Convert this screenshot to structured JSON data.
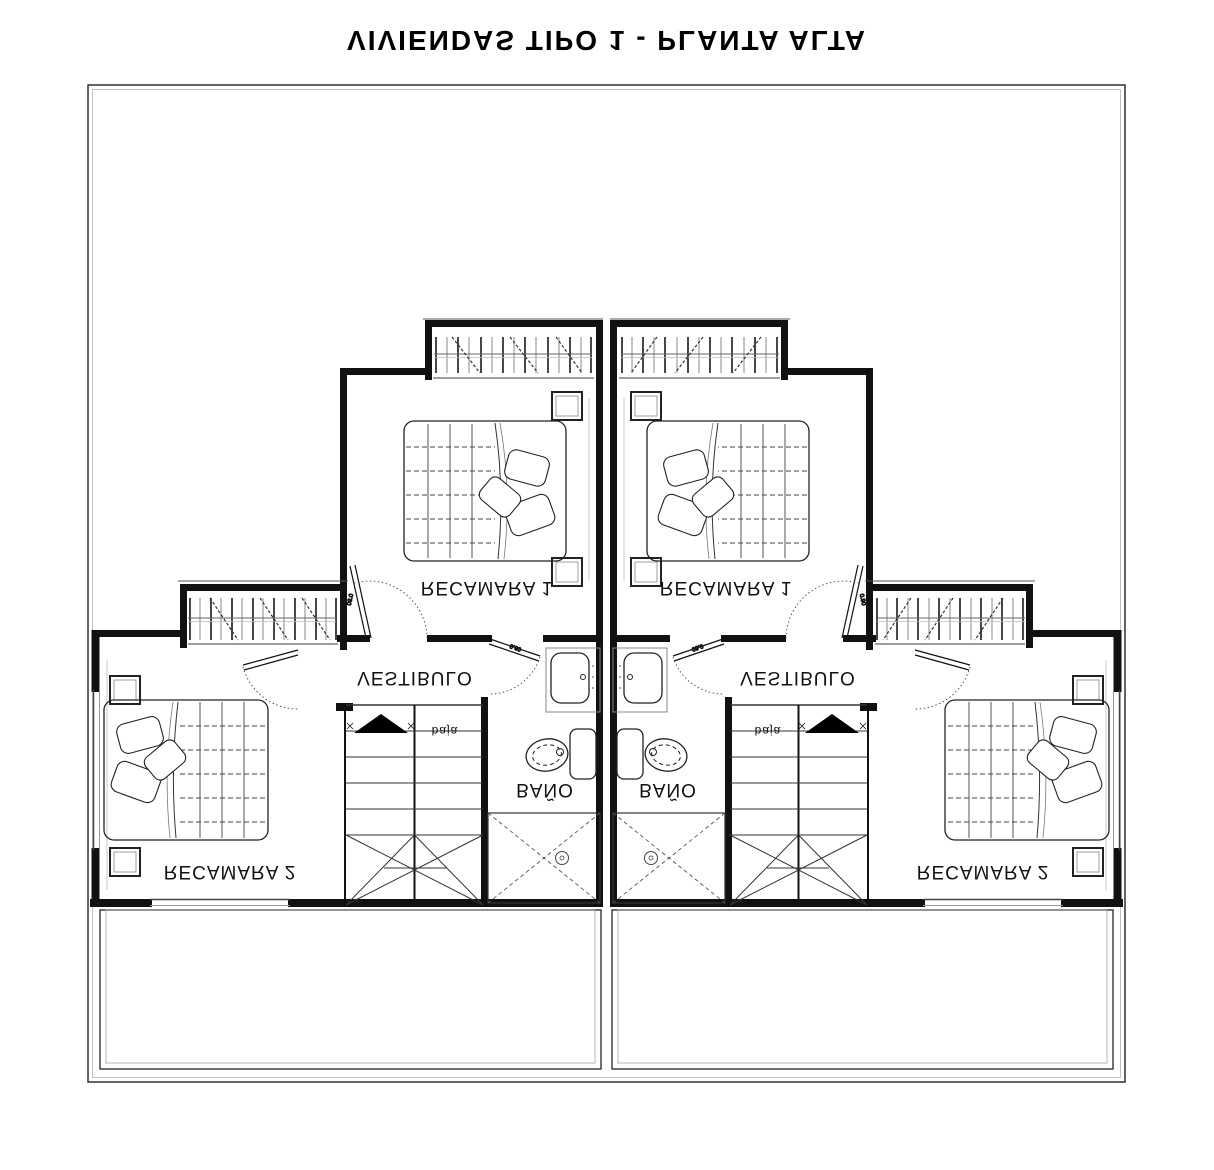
{
  "title": "VIVIENDAS TIPO 1 - PLANTA ALTA",
  "rooms": {
    "bedroom1": "RECAMARA 1",
    "bedroom2": "RECAMARA 2",
    "hall": "VESTIBULO",
    "bath": "BAÑO"
  },
  "stairs": {
    "direction_label": "baja"
  },
  "door_dimensions": {
    "bedroom_door": "0.90",
    "bath_door": "0.60"
  },
  "colors": {
    "ink": "#111111",
    "light_line": "#999999",
    "paper": "#ffffff"
  }
}
